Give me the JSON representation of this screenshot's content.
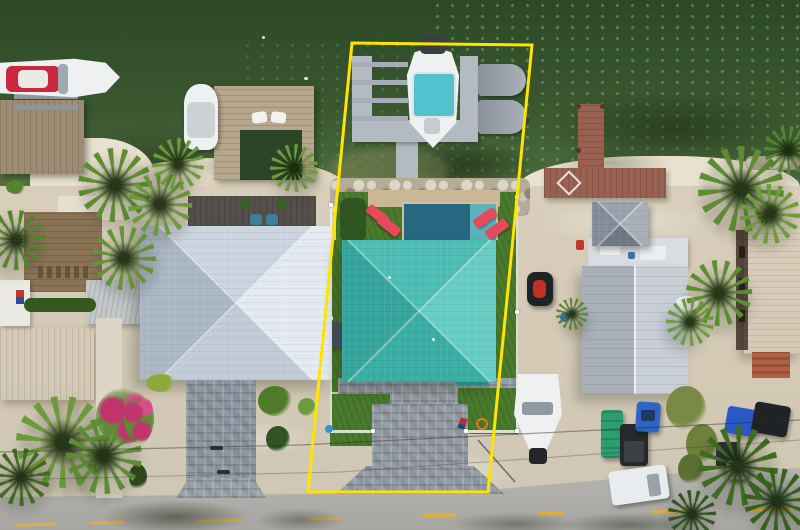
{
  "scene": {
    "type": "aerial-drone-photo",
    "subject": "canal-front home with boat dock, outlined property boundary"
  },
  "boundary": {
    "color": "#ffe400",
    "stroke_width": "3",
    "points": "352,43 532,45 488,492 308,492"
  },
  "colors": {
    "water_deep": "#2c4827",
    "water_mid": "#3a5730",
    "water_shallow": "#5d7245",
    "sand": "#d8cebb",
    "sand_bright": "#e9e1cf",
    "sand_shoulder": "#cfc7b5",
    "road": "#a8a6a2",
    "road_light": "#b8b6b2",
    "road_marking": "#dfae3c",
    "rock_base": "#b4ac96",
    "rock_light": "#ddd7c7",
    "rock_dark": "#8e8773",
    "turf": "#4a7a2c",
    "turf_dark": "#2f5520",
    "hedge": "#33591f",
    "pool": "#25687f",
    "pool_step": "#5fb0ba",
    "coping": "#cab795",
    "lounger": "#e8495c",
    "teal_roof_top": "#4cbcb4",
    "teal_roof_right": "#66ccc4",
    "teal_roof_bottom": "#3aada5",
    "teal_roof_left": "#35a59d",
    "white_roof_top": "#cbd4df",
    "white_roof_right": "#e4eaf1",
    "white_roof_bottom": "#c2ccd8",
    "white_roof_left": "#adb8c6",
    "gray_roof_left": "#a9b0ba",
    "gray_roof_right": "#c9cfd7",
    "ridge": "#eef1f4",
    "gazebo_top": "#99a1ac",
    "gazebo_right": "#a7aeb8",
    "gazebo_bottom": "#6f7884",
    "gazebo_left": "#848d99",
    "orange_roof": "#d96b3d",
    "orange_roof_dark": "#c25a30",
    "red_dock": "#9a6050",
    "wood_dock": "#b7a78c",
    "wood_gray": "#9d8c73",
    "deck_dark": "#55504a",
    "dock_gray": "#b4bac1",
    "dock_arm": "#a6adb6",
    "boat_white": "#eef0f1",
    "boat_red": "#c8293e",
    "bimini": "#52c2cf",
    "motor_dark": "#3a3e42",
    "paver": "#969da6",
    "paver_light": "#b6bbc1",
    "palm_green": "#5d8c33",
    "palm_light": "#6d9a3c",
    "palm_dark": "#3f6b22",
    "palm_deep": "#2f5520",
    "scrub_olive": "#7a8a44",
    "bougainvillea": "#c0356e",
    "van_white": "#e9ecef",
    "car_blue": "#2f63c4",
    "car_blue2": "#2a58c8",
    "suv_dark": "#202326",
    "truck_green": "#2e9e72",
    "vehicle_dark": "#26292c",
    "trailer_gray": "#d5d8da",
    "jetski_dark": "#1f2326",
    "jetski_red": "#c03028",
    "barrel_blue": "#2a6fd4",
    "shed_white": "#eceae4",
    "tin_roof": "#c3c7ca",
    "dirt_brown": "#8b7356",
    "wire": "#30332c"
  },
  "objects": [
    "yellow-property-boundary",
    "canal-water",
    "boat-on-lift-with-teal-bimini",
    "jet-ski-lifts",
    "concrete-dock",
    "riprap-seawall",
    "swimming-pool",
    "red-loungers",
    "teal-hip-roof-house",
    "white-hip-roof-house",
    "gray-gable-roof-house",
    "rooftop-gazebo",
    "red-wood-dock",
    "left-wood-dock",
    "red-white-speedboat",
    "white-moored-boat",
    "paver-driveways",
    "artificial-turf",
    "palm-trees",
    "bougainvillea",
    "parked-vehicles",
    "white-van",
    "boat-on-trailer",
    "road-with-yellow-dashes",
    "orange-tile-roofs"
  ]
}
